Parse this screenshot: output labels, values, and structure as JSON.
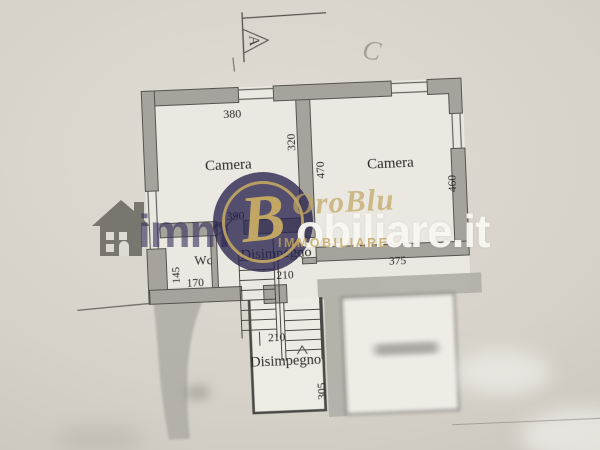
{
  "annotations": {
    "section_letter": "A",
    "handwritten_letter": "C"
  },
  "rooms": {
    "camera_left": "Camera",
    "camera_right": "Camera",
    "wc": "Wc",
    "disimpegno_upper": "Disimpegno",
    "disimpegno_lower": "Disimpegno"
  },
  "dimensions": {
    "camera_left_width": "380",
    "camera_left_height": "320",
    "inner_wall_height": "470",
    "camera_right_height": "460",
    "camera_right_width": "375",
    "hall_width": "390",
    "wc_height": "145",
    "wc_width": "170",
    "hall_depth": "210",
    "door_width": "90",
    "stair_run": "210",
    "lower_room_height": "305"
  },
  "watermark": {
    "text_prefix": "imm",
    "text_suffix": "obiliare.it",
    "brand_script": "OroBlu",
    "brand_caps": "IMMOBILIARE",
    "monogram": "B",
    "colors": {
      "navy": "#38345f",
      "gold": "#c1a464",
      "white": "#faf8f2"
    }
  },
  "colors": {
    "paper": "#d6d2c9",
    "wall_fill": "#a5a39c",
    "wall_line": "#55534d",
    "ink": "#2b2a27"
  }
}
